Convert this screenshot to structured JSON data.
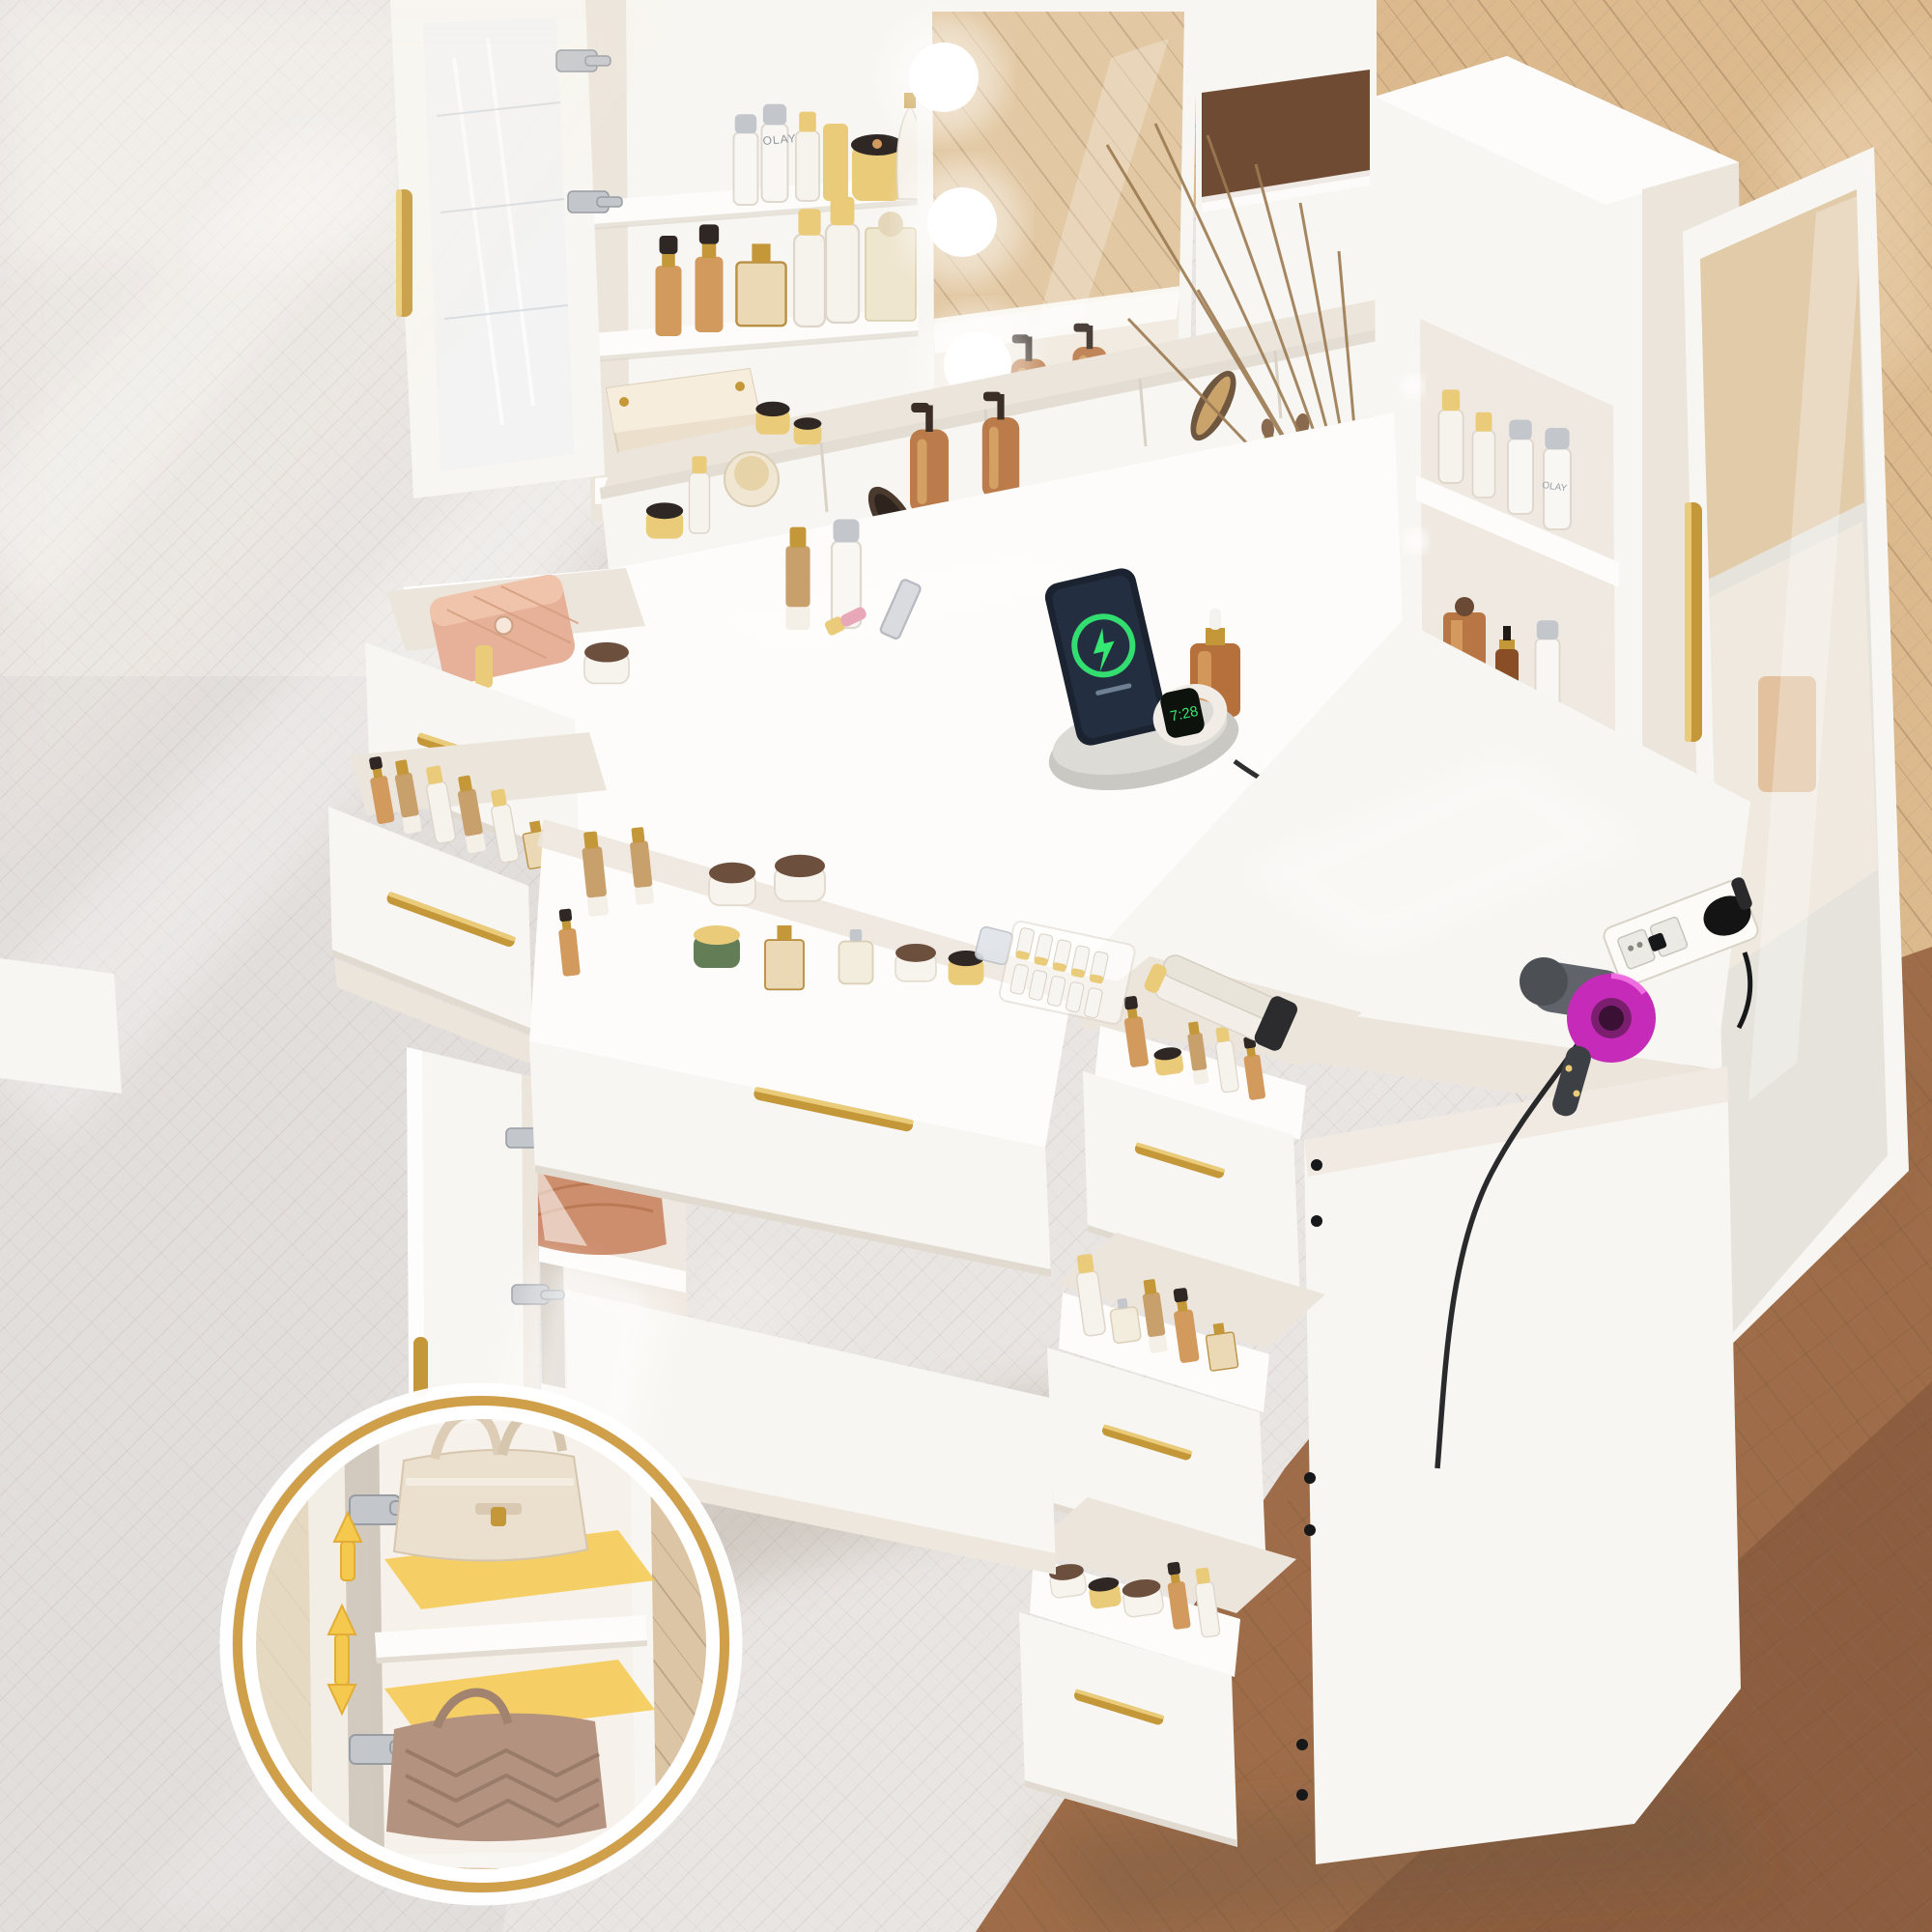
{
  "meta": {
    "kind": "e-commerce product photo",
    "subject": "white makeup vanity desk with lighted mirror, open storage and cosmetics, viewed from above on wood flooring"
  },
  "colors": {
    "floor_base": "#e9e5e2",
    "floor_light": "#f7f4f1",
    "floor_cool": "#dcd7d6",
    "oak": "#dcba8e",
    "oak_deep": "#c49a6c",
    "brown": "#9e6c48",
    "brown_deep": "#7d5236",
    "walnut": "#6f4b33",
    "white": "#f8f6f2",
    "bright": "#fdfcfa",
    "shade": "#ece5dc",
    "deep": "#dbd3c8",
    "dim": "#c8bfb2",
    "gold": "#c49739",
    "gold_light": "#e9cb79",
    "gold_deep": "#a1762a",
    "silver": "#c3c6cb",
    "silver_deep": "#989ca3",
    "acrylic": "#eef1f4",
    "mirror_tan": "#e0c49c",
    "amber": "#b5703c",
    "amber_light": "#d39a5e",
    "amber_deep": "#8a4e26",
    "bronze": "#6d4f3d",
    "darklid": "#2e2723",
    "cream": "#ece0cd",
    "cream_bag": "#ebdfce",
    "taupe_bag": "#b3927f",
    "peach_bag": "#cd8e6e",
    "pouch_pink": "#e6b198",
    "green_jar": "#637d57",
    "screen_green": "#35e873",
    "phone_dark": "#1b2330",
    "dock_gray": "#cac8c3",
    "magenta": "#c62ab8",
    "magenta_deep": "#7c1e70",
    "tool_gray": "#60646a",
    "dark": "#17181a",
    "yellow": "#f5c94e",
    "ring_gold": "#cf9f4a",
    "led": "#ffffff"
  },
  "scene": {
    "brand_label": "OLAY",
    "watch_time": "7:28"
  },
  "objects": [
    "hollywood mirror with led bulbs",
    "glass-door wall cabinet with gold handle",
    "open acrylic cabinet door",
    "skincare bottles and perfume shelves",
    "tissue box holder",
    "tabletop organizer compartments",
    "amber pump dispenser bottles",
    "hair brushes and comb",
    "makeup brush holder",
    "reed diffuser",
    "white desktop",
    "wireless charging dock with phone",
    "smart watch on charger",
    "charging cable",
    "amber dropper serum bottle",
    "lipsticks and perfume on desk",
    "two open left drawers with cosmetics",
    "wide open center drawer with jars and perfumes",
    "lower cabinet with open door and handbag",
    "spotlight beam to detail inset",
    "magnified inset: adjustable shelf cabinet with two handbags",
    "yellow adjustable-shelf arrows",
    "concealed hinges",
    "right storage tower with open shelves",
    "mirrored tower door with gold handle",
    "sunglasses on tower shelf",
    "side desktop extension",
    "built-in power strip with plugs",
    "purple hair dryer",
    "white hair curler",
    "right pedestal with three open drawers",
    "gold bar drawer handles",
    "herringbone whitewashed floor",
    "oak and walnut toned floor",
    "sunlight streaks"
  ]
}
